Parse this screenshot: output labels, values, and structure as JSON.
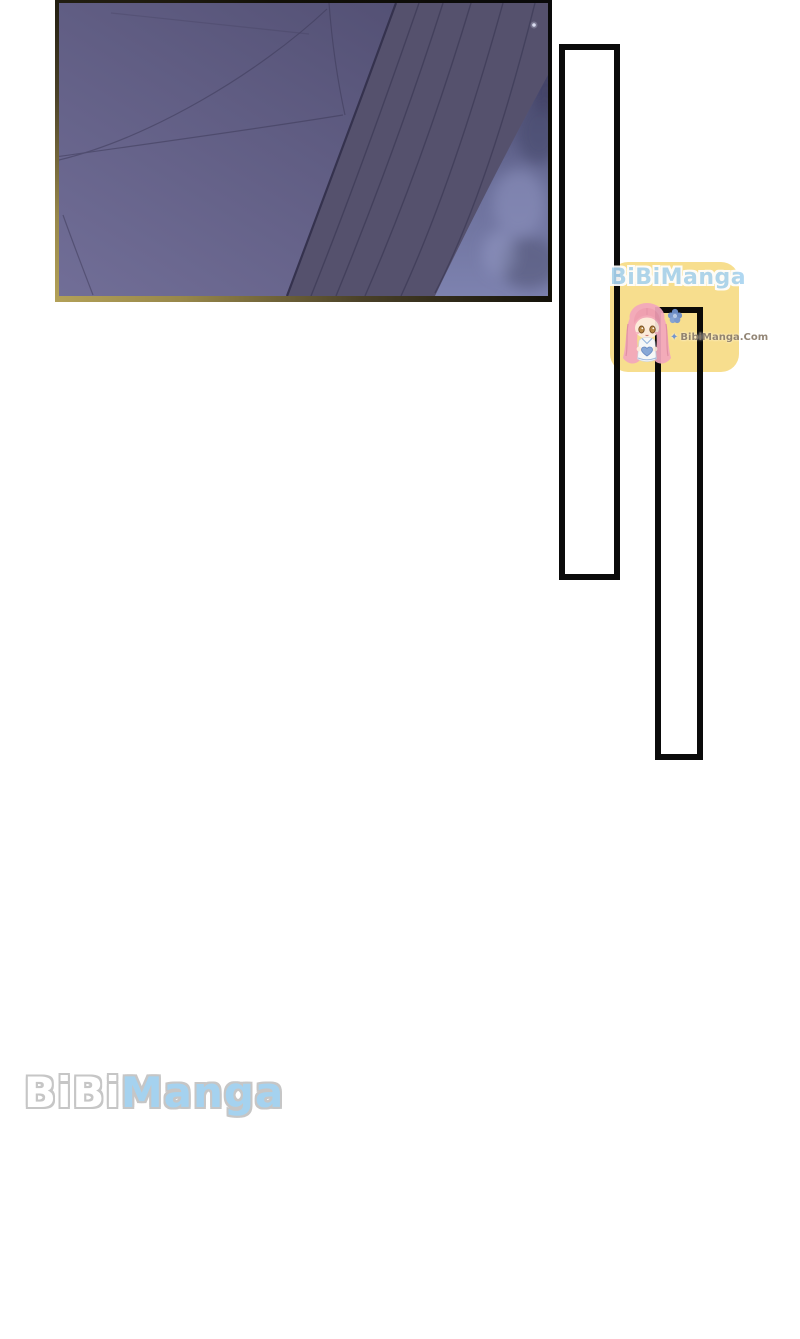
{
  "page": {
    "kind": "manga-webtoon-page",
    "width": 800,
    "height": 1339,
    "background_color": "#ffffff"
  },
  "manga_panel": {
    "description": "purple dome interior with large curved arch band and soft blue glow",
    "colors": {
      "sky_dark": "#4e4b6e",
      "sky_light": "#716e97",
      "arch_band": "#55516d",
      "arch_seam": "#413e5a",
      "blue_glow": "#7d82af",
      "frame_gold": "#b3a158",
      "frame_black": "#0b0b0b",
      "star": "#d9dcf0"
    }
  },
  "empty_frames": [
    {
      "id": "frame-1",
      "border_color": "#0b0b0b"
    },
    {
      "id": "frame-2",
      "border_color": "#0b0b0b"
    }
  ],
  "watermark": {
    "title": "BiBiManga",
    "site_url": "BibiManga.Com",
    "sparkle_icon": "✦",
    "bg_color": "#f7dd8a",
    "title_color": "#a9d4f0",
    "site_color": "#8b7d6c",
    "mascot": "chibi-girl-pink-hair"
  },
  "footer_logo": {
    "part1": "BiBi",
    "part2": "Manga",
    "part1_color": "#ffffff",
    "part2_color": "#a5d2ef",
    "outline_color": "#c6c6c6"
  }
}
